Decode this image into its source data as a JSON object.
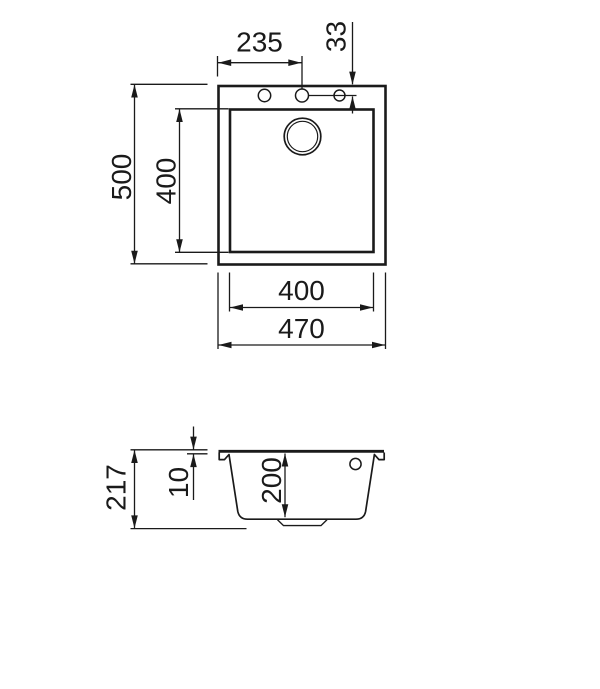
{
  "colors": {
    "line": "#1a1a1a",
    "background": "#ffffff"
  },
  "top_view": {
    "dim_tap_center_from_left": "235",
    "dim_tap_hole_offset": "33",
    "dim_outer_depth": "500",
    "dim_inner_depth": "400",
    "dim_inner_width": "400",
    "dim_outer_width": "470"
  },
  "side_view": {
    "dim_total_height": "217",
    "dim_rim_thickness": "10",
    "dim_bowl_depth": "200"
  }
}
